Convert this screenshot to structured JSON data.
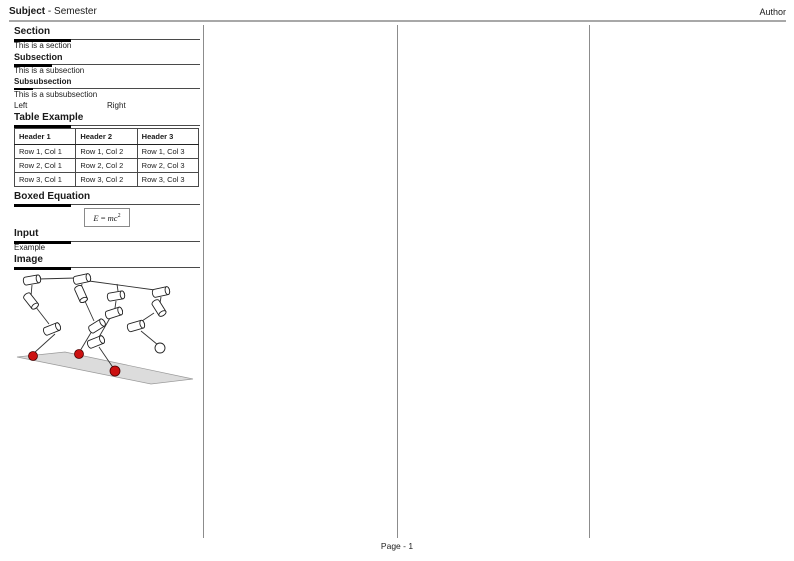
{
  "page": {
    "header": {
      "subject": "Subject",
      "separator": "-",
      "semester": "Semester",
      "author": "Author"
    },
    "footer": {
      "page_number": "Page - 1"
    }
  },
  "content": {
    "section": {
      "title": "Section",
      "body": "This is a section"
    },
    "subsection": {
      "title": "Subsection",
      "body": "This is a subsection"
    },
    "subsubsection": {
      "title": "Subsubsection",
      "body": "This is a subsubsection"
    },
    "two_columns": {
      "left": "Left",
      "right": "Right"
    },
    "table": {
      "title": "Table Example",
      "headers": [
        "Header 1",
        "Header 2",
        "Header 3"
      ],
      "rows": [
        [
          "Row 1, Col 1",
          "Row 1, Col 2",
          "Row 1, Col 3"
        ],
        [
          "Row 2, Col 1",
          "Row 2, Col 2",
          "Row 2, Col 3"
        ],
        [
          "Row 3, Col 1",
          "Row 3, Col 2",
          "Row 3, Col 3"
        ]
      ]
    },
    "boxed_equation": {
      "title": "Boxed Equation",
      "lhs": "E",
      "relation": "=",
      "rhs_base": "mc",
      "rhs_exponent": "2"
    },
    "input": {
      "title": "Input",
      "body": "Example"
    },
    "image": {
      "title": "Image",
      "figure": "legged-robot-linkage-wireframe"
    }
  },
  "colors": {
    "foot_marker_red": "#cc1111",
    "ground_plane_gray": "#dcdcdc",
    "header_rule_gray": "#a8a8a8",
    "divider_gray": "#8c8c8c"
  }
}
